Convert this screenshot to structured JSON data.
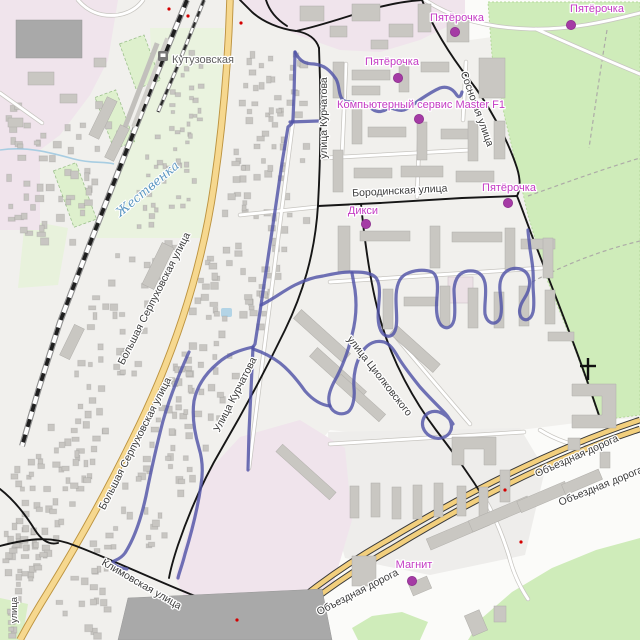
{
  "map": {
    "street_labels": [
      {
        "text": "Большая Серпуховская улица"
      },
      {
        "text": "Большая Серпуховская улица"
      },
      {
        "text": "улица Курчатова"
      },
      {
        "text": "Улица Курчатова"
      },
      {
        "text": "улица Циолковского"
      },
      {
        "text": "Бородинская улица"
      },
      {
        "text": "Сосновая улица"
      },
      {
        "text": "Объездная дорога"
      },
      {
        "text": "Объездная дорога"
      },
      {
        "text": "Объездная дорога"
      },
      {
        "text": "Климовская улица"
      },
      {
        "text": "улица"
      }
    ],
    "station_label": "Кутузовская",
    "river_label": "Жественка",
    "poi": [
      {
        "label": "Пятёрочка"
      },
      {
        "label": "Пятёрочка"
      },
      {
        "label": "Пятёрочка"
      },
      {
        "label": "Компьютерный сервис Master F1"
      },
      {
        "label": "Пятёрочка"
      },
      {
        "label": "Дикси"
      },
      {
        "label": "Магнит"
      }
    ],
    "colors": {
      "track": "#5153a7",
      "poi_dot": "#a53ba5",
      "poi_text": "#c43bc4",
      "forest_green": "#cfecba",
      "road_yellow": "#f6d88f",
      "industrial_pink": "#f0e4ec",
      "building_gray": "#c9c7c2"
    }
  }
}
